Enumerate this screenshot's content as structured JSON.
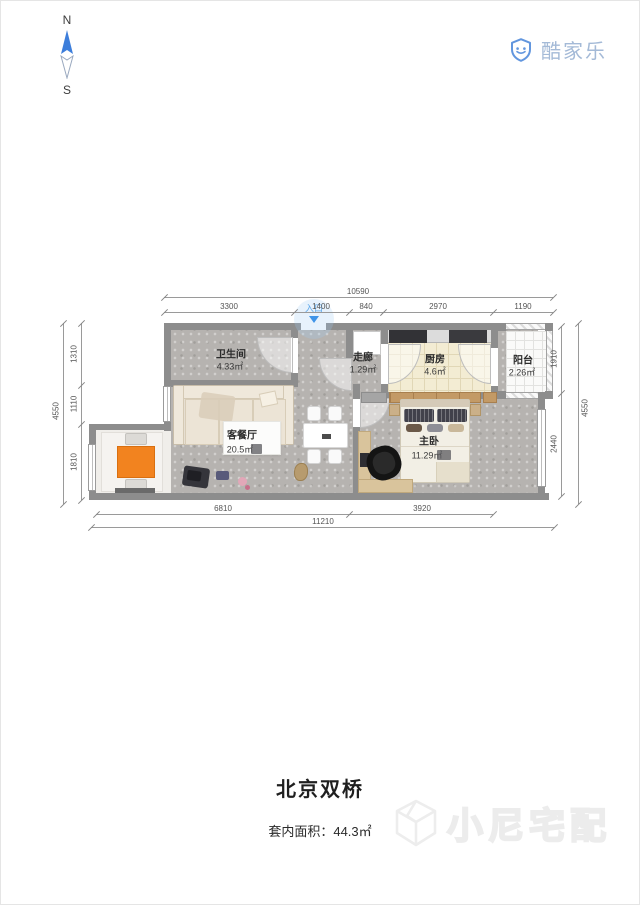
{
  "compass": {
    "north": "N",
    "south": "S"
  },
  "logo": {
    "text": "酷家乐"
  },
  "entrance": {
    "label": "入口"
  },
  "rooms": [
    {
      "name": "卫生间",
      "area": "4.33㎡"
    },
    {
      "name": "走廊",
      "area": "1.29㎡"
    },
    {
      "name": "厨房",
      "area": "4.6㎡"
    },
    {
      "name": "阳台",
      "area": "2.26㎡"
    },
    {
      "name": "客餐厅",
      "area": "20.5㎡"
    },
    {
      "name": "主卧",
      "area": "11.29㎡"
    }
  ],
  "dimensions": {
    "top_total": "10590",
    "top_segments": [
      "3300",
      "1400",
      "840",
      "2970",
      "1190"
    ],
    "left_total": "4550",
    "left_segments": [
      "1310",
      "1110",
      "1810"
    ],
    "right_total": "4550",
    "right_segments": [
      "1910",
      "2440"
    ],
    "bottom_total": "11210",
    "bottom_segments": [
      "6810",
      "3920"
    ]
  },
  "footer": {
    "title": "北京双桥",
    "area_label": "套内面积：44.3㎡",
    "watermark": "小尼宅配"
  },
  "colors": {
    "wall": "#8d8d8d",
    "accent_blue": "#3f94e8",
    "logo_blue": "#6296de",
    "orange_table": "#f2831f"
  }
}
